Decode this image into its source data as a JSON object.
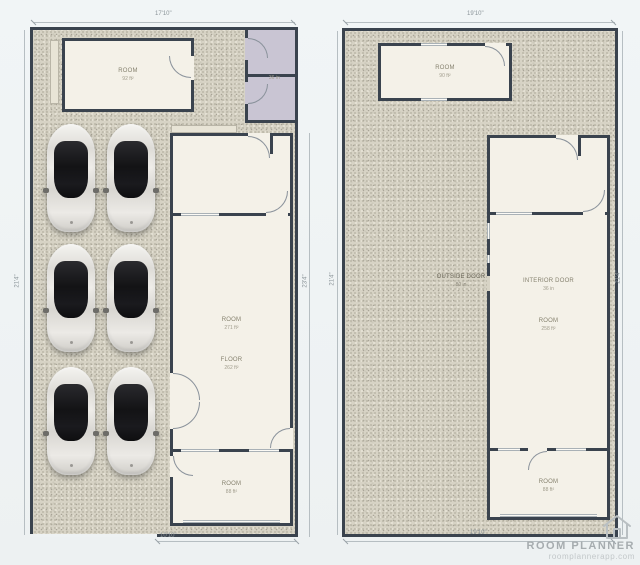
{
  "watermark": {
    "brand": "ROOM PLANNER",
    "url": "roomplannerapp.com",
    "icon": "house-icon"
  },
  "colors": {
    "wall": "#3a434e",
    "floor_gravel": "#d7d3c5",
    "room_fill": "#f4f1e8",
    "lavender_room_fill": "#c9c5d3",
    "car_body": "#e6e4df",
    "car_glass": "#17171a",
    "dimension_text": "#8b9499"
  },
  "left_plan": {
    "dim_top": "17'10\"",
    "dim_left": "21'4\"",
    "dim_right": "23'4\"",
    "dim_bottom": "10'10\"",
    "top_room": {
      "name": "ROOM",
      "detail": "92 ft²"
    },
    "lavender_divider_label": "36 in",
    "main_room_labels": [
      {
        "name": "ROOM",
        "detail": "271 ft²"
      },
      {
        "name": "FLOOR",
        "detail": "262 ft²"
      }
    ],
    "bottom_room": {
      "name": "ROOM",
      "detail": "88 ft²"
    },
    "car_count": "6"
  },
  "right_plan": {
    "dim_top": "19'10\"",
    "dim_left": "21'4\"",
    "dim_right": "21'4\"",
    "dim_bottom": "19'10\"",
    "top_room": {
      "name": "ROOM",
      "detail": "90 ft²"
    },
    "outside_label": {
      "name": "OUTSIDE DOOR",
      "detail": "80 in"
    },
    "main_room_labels": [
      {
        "name": "INTERIOR DOOR",
        "detail": "36 in"
      },
      {
        "name": "ROOM",
        "detail": "258 ft²"
      }
    ],
    "bottom_room": {
      "name": "ROOM",
      "detail": "88 ft²"
    }
  }
}
